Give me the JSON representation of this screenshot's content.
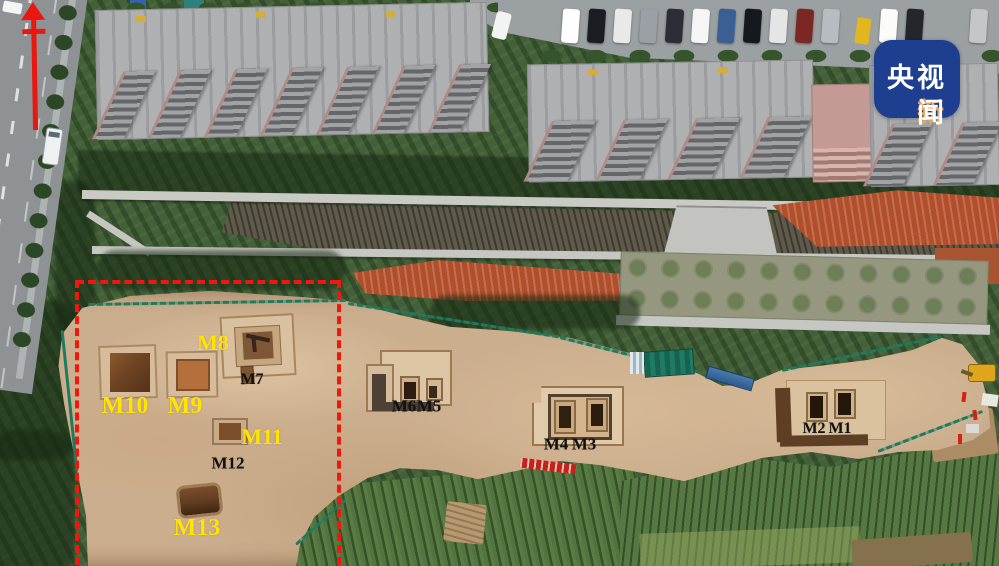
{
  "badge": {
    "line1": "央视",
    "line2_accent": "新",
    "line2_rest": "闻",
    "bg_color": "#1e3f8f",
    "text_color": "#ffffff",
    "accent_color": "#e9a55e"
  },
  "annotations": {
    "north_arrow": {
      "color": "#e8170f"
    },
    "boundary_box": {
      "color": "#f2170c",
      "style": "dashed",
      "left": 76,
      "top": 281,
      "right": 338,
      "bottom": 566
    },
    "label_colors": {
      "yellow": "#ffe400",
      "black": "#111111"
    },
    "tomb_labels": [
      {
        "text": "M8",
        "color": "#ffe400",
        "x": 213,
        "y": 343,
        "size": 22
      },
      {
        "text": "M7",
        "color": "#111111",
        "x": 252,
        "y": 380,
        "size": 16
      },
      {
        "text": "M10",
        "color": "#ffe400",
        "x": 125,
        "y": 406,
        "size": 24
      },
      {
        "text": "M9",
        "color": "#ffe400",
        "x": 185,
        "y": 406,
        "size": 24
      },
      {
        "text": "M6",
        "color": "#111111",
        "x": 404,
        "y": 406,
        "size": 17
      },
      {
        "text": "M5",
        "color": "#111111",
        "x": 429,
        "y": 406,
        "size": 17
      },
      {
        "text": "M11",
        "color": "#ffe400",
        "x": 262,
        "y": 437,
        "size": 22
      },
      {
        "text": "M12",
        "color": "#111111",
        "x": 228,
        "y": 463,
        "size": 17
      },
      {
        "text": "M4",
        "color": "#111111",
        "x": 556,
        "y": 444,
        "size": 17
      },
      {
        "text": "M3",
        "color": "#111111",
        "x": 584,
        "y": 444,
        "size": 17
      },
      {
        "text": "M2",
        "color": "#111111",
        "x": 814,
        "y": 429,
        "size": 16
      },
      {
        "text": "M1",
        "color": "#111111",
        "x": 840,
        "y": 429,
        "size": 16
      },
      {
        "text": "M13",
        "color": "#ffe400",
        "x": 197,
        "y": 528,
        "size": 24
      }
    ]
  }
}
